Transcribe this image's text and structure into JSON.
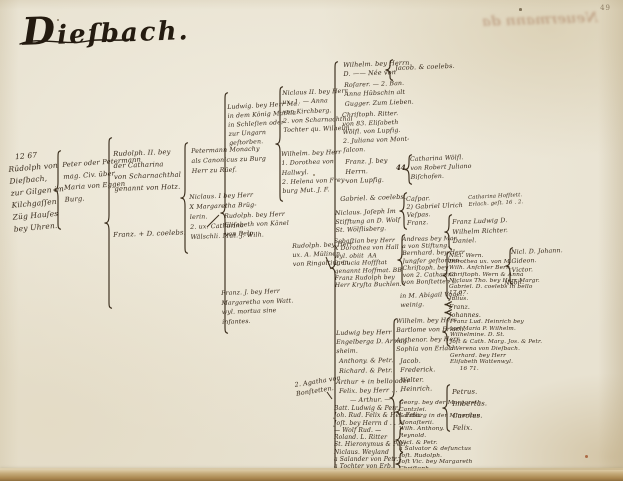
{
  "page": {
    "title": "Dieſbach.",
    "page_number": "49",
    "showthrough_text": "Neuermann da",
    "colors": {
      "ink": "#35281a",
      "ink_dark": "#241b10",
      "paper": "#e8e2d1",
      "bottom_edge": "#aa874f"
    }
  },
  "tree": {
    "entries": [
      {
        "id": "gen1-rudolph",
        "x": 7,
        "y": 152,
        "size": 7.5,
        "lh": 12,
        "rot": -5,
        "lines": [
          "   12 67",
          "Rüdolph von",
          "Dieſbach,",
          "zur Gilgen im",
          "Kilchgaſſen",
          "Züg Hauſes",
          "bey Uhren."
        ]
      },
      {
        "id": "gen2-peter",
        "x": 62,
        "y": 160,
        "size": 6.8,
        "lh": 11.5,
        "rot": -4,
        "lines": [
          "Peter oder Petermann",
          "mag. Civ. über",
          "Maria von Eggen",
          "Burg."
        ]
      },
      {
        "id": "gen3-rudolph-ii",
        "x": 113,
        "y": 149,
        "size": 6.8,
        "lh": 11.5,
        "rot": -2,
        "lines": [
          "Rudolph. II. bey",
          "der Catharina",
          "von Scharnachthal",
          "genannt von Hotz."
        ]
      },
      {
        "id": "gen3-franz-coelebs",
        "x": 113,
        "y": 231,
        "size": 6.8,
        "lh": 9,
        "rot": -2,
        "lines": [
          "Franz. + D. coelebs."
        ]
      },
      {
        "id": "gen4-petermann-monachy",
        "x": 191,
        "y": 147,
        "size": 6.3,
        "lh": 10,
        "rot": -2,
        "lines": [
          "Petermann Monachy",
          "als Canonicus zu Burg",
          "Herr zu Rüef."
        ]
      },
      {
        "id": "gen4-niclaus-i",
        "x": 189,
        "y": 193,
        "size": 6.3,
        "lh": 10,
        "rot": -2,
        "lines": [
          "Niclaus. I bey Herr",
          "X Margaretha Brüg-",
          "lerin.",
          "2. ux. Catharina",
          "Wälschli. Mut. J. Wilh."
        ]
      },
      {
        "id": "gen5-ludwig",
        "x": 227,
        "y": 103,
        "size": 6.2,
        "lh": 9,
        "rot": -3,
        "lines": [
          "Ludwig. bey Herr Ma.",
          "in dem König Mathia",
          "in Schleſien oder",
          "zur Ungarn",
          "geſtorben."
        ]
      },
      {
        "id": "gen5-rudolph",
        "x": 224,
        "y": 212,
        "size": 6.2,
        "lh": 9,
        "rot": -2,
        "lines": [
          "Rudolph. bey Herr",
          "Eliſabeth von Känel",
          "von Belp."
        ]
      },
      {
        "id": "gen5-franz",
        "x": 221,
        "y": 289,
        "size": 6.2,
        "lh": 9.5,
        "rot": -2,
        "lines": [
          "Franz. J. bey Herr",
          "Margaretha von Watt.",
          "wyl. mortua sine",
          "infantes."
        ]
      },
      {
        "id": "gen6-niclaus-ii",
        "x": 282,
        "y": 89,
        "size": 6.2,
        "lh": 9.3,
        "rot": -2,
        "lines": [
          "Niclaus II. bey Herr",
          "ux. 1. — Anna",
          "von Kirchberg.",
          "2. von Scharnachthal",
          "Tochter qu. Wilhelm."
        ]
      },
      {
        "id": "gen6-wilhelm",
        "x": 281,
        "y": 150,
        "size": 6.2,
        "lh": 9.3,
        "rot": -2,
        "lines": [
          "Wilhelm. bey Herr",
          "1. Dorothea von",
          "Hallwyl.",
          "2. Helena von Frey-",
          "burg Mut. J. F."
        ]
      },
      {
        "id": "gen6-rudolph",
        "x": 292,
        "y": 242,
        "size": 6.2,
        "lh": 9,
        "rot": -2,
        "lines": [
          "Rudolph. bey Herr",
          "ux. A. Mülinen",
          "von Ringoltingen."
        ]
      },
      {
        "id": "note-agatha",
        "x": 294,
        "y": 381,
        "size": 6.4,
        "lh": 9,
        "rot": -9,
        "lines": [
          "2. Agatha von",
          "Bonſtetten."
        ]
      },
      {
        "id": "gen7-wilhelm",
        "x": 343,
        "y": 61,
        "size": 6.4,
        "lh": 9,
        "rot": -2,
        "lines": [
          "Wilhelm. bey Herrn",
          "D. —— Née von"
        ]
      },
      {
        "id": "gen7-rosarer",
        "x": 344,
        "y": 81,
        "size": 6.2,
        "lh": 9.3,
        "rot": -2,
        "lines": [
          "Roſarer. — 2. Ban.",
          "Anna Hübschin alt",
          "Gugger. Zum Lieben."
        ]
      },
      {
        "id": "gen7-christoph",
        "x": 342,
        "y": 112,
        "size": 6.2,
        "lh": 8.7,
        "rot": -2,
        "lines": [
          "Chriſtoph. Ritter.",
          "von 83. Eliſabeth",
          "Wölfl. von Lupfig.",
          "2. Juliana von Mont-",
          "falcon."
        ]
      },
      {
        "id": "gen7-franz",
        "x": 345,
        "y": 158,
        "size": 6.4,
        "lh": 9.5,
        "rot": -2,
        "lines": [
          "Franz. J. bey",
          "Herrn.",
          "von Lupfig."
        ]
      },
      {
        "id": "gen7-gabriel",
        "x": 340,
        "y": 195,
        "size": 6.5,
        "lh": 9,
        "rot": -2,
        "lines": [
          "Gabriel. & coelebs."
        ]
      },
      {
        "id": "gen7-niclaus-joseph",
        "x": 335,
        "y": 210,
        "size": 6.2,
        "lh": 8.5,
        "rot": -2,
        "lines": [
          "Niclaus. Joſeph Im",
          "Stifftung an D. Wolf",
          "St. Wölflisberg."
        ]
      },
      {
        "id": "gen7-sebastian",
        "x": 334,
        "y": 238,
        "size": 6,
        "lh": 7.4,
        "rot": -1,
        "lines": [
          "Sebaſtian bey Herr",
          "X Dorothea von Hall",
          "wyl. obiit  AA",
          "2. Lucia Hoffſtat",
          "genannt Hoffmat. BB",
          "Franz Rudolph bey",
          "Herr Kryſta Buchlen."
        ]
      },
      {
        "id": "gen7-abigail",
        "x": 400,
        "y": 293,
        "size": 6.2,
        "lh": 8.5,
        "rot": -2,
        "lines": [
          "in M. Abigail Vogel.",
          "weinig."
        ]
      },
      {
        "id": "gen7-ludwig",
        "x": 336,
        "y": 330,
        "size": 6.2,
        "lh": 8.8,
        "rot": -1,
        "lines": [
          "Ludwig bey Herr",
          "Engelberga D. Armag.",
          "sheim."
        ]
      },
      {
        "id": "gen7-anthony",
        "x": 339,
        "y": 358,
        "size": 6.3,
        "lh": 8,
        "rot": -1,
        "lines": [
          "Anthony. & Petr."
        ]
      },
      {
        "id": "gen7-richard",
        "x": 339,
        "y": 368,
        "size": 6.3,
        "lh": 8,
        "rot": -1,
        "lines": [
          "Richard. & Petr."
        ]
      },
      {
        "id": "gen7-arthur-bello",
        "x": 336,
        "y": 379,
        "size": 6.3,
        "lh": 8,
        "rot": -1,
        "lines": [
          "Arthur + in bello oder"
        ]
      },
      {
        "id": "gen7-felix",
        "x": 339,
        "y": 388,
        "size": 6.3,
        "lh": 8,
        "rot": -1,
        "lines": [
          "Felix. bey Herr . . ."
        ]
      },
      {
        "id": "gen7-arthur",
        "x": 350,
        "y": 397,
        "size": 6.3,
        "lh": 8,
        "rot": -1,
        "lines": [
          "— Arthur. —"
        ]
      },
      {
        "id": "gen7-list",
        "x": 334,
        "y": 405,
        "size": 6,
        "lh": 7.3,
        "rot": 0,
        "lines": [
          "Batt. Ludwig & Petr.",
          "Joh. Rud. Felix & Hel. Felix",
          "Joſt. bey Herrn d . . . .",
          "— Wolf Rud. —",
          "Roland. L. Ritter",
          "St. Hieronymus & Petr.",
          "Niclaus. Weyland",
          "a Salander von Petr.",
          "a Tochter von Erb."
        ]
      },
      {
        "id": "gen8-jacob-coelebs",
        "x": 395,
        "y": 64,
        "size": 6.5,
        "lh": 9,
        "rot": -2,
        "lines": [
          "Jacob. & coelebs."
        ]
      },
      {
        "id": "gen8-catharina",
        "x": 410,
        "y": 156,
        "size": 6.2,
        "lh": 8.8,
        "rot": -2,
        "lines": [
          "Catharina Wölfl.",
          "von Robert Juliano",
          "Biſchofen."
        ]
      },
      {
        "id": "gen8-caspar",
        "x": 406,
        "y": 196,
        "size": 6.3,
        "lh": 8,
        "rot": -2,
        "lines": [
          "Caſpar.",
          "2) Gabriel Ulrich",
          "Veſpas.",
          "Franz."
        ]
      },
      {
        "id": "gen8-andreas",
        "x": 402,
        "y": 236,
        "size": 6,
        "lh": 7.2,
        "rot": -1,
        "lines": [
          "Andreas bey Mar.",
          "a von Stiftung.",
          "Bernhard. bey Herr",
          "Jungfer geſtorben.",
          "Chriſtoph. bey",
          "von 2. Catharina",
          "von Bonſtetten L."
        ]
      },
      {
        "id": "gen8-wilhelm-erlach",
        "x": 396,
        "y": 318,
        "size": 6.2,
        "lh": 8.5,
        "rot": -1,
        "lines": [
          "Wilhelm. bey Herr",
          "Bartlome von Erlach."
        ]
      },
      {
        "id": "gen8-anthenor-erlach",
        "x": 396,
        "y": 337,
        "size": 6.2,
        "lh": 8.5,
        "rot": -1,
        "lines": [
          "Anthenor. bey Herr",
          "Sophia von Erlach."
        ]
      },
      {
        "id": "gen8-sons",
        "x": 400,
        "y": 357,
        "size": 6.4,
        "lh": 9.3,
        "rot": -1,
        "lines": [
          "Jacob.",
          "Frederick.",
          "Walter.",
          "Heinrich."
        ]
      },
      {
        "id": "gen8-georg-list",
        "x": 399,
        "y": 400,
        "size": 5.9,
        "lh": 6.6,
        "rot": 0,
        "lines": [
          "Georg. bey der Margareth",
          "Cantzlei.",
          "Salzburg in der Minoriten",
          "Monaſterii.",
          "Wilh. Anthony.",
          "Reynold.",
          "Nicl. & Petr.",
          "a Salvator & defunctus",
          "Joſt. Rudolph.",
          "Joſt Vic. bey Margareth",
          "Chriſtoph.",
          "Deutſchland."
        ]
      },
      {
        "id": "gen9-note-catharina",
        "x": 468,
        "y": 195,
        "size": 5.3,
        "lh": 7,
        "rot": -3,
        "lines": [
          "Catharina Hofſtett.",
          "Erlach. geſt. 16 . 2."
        ]
      },
      {
        "id": "gen9-franz-ludwig",
        "x": 452,
        "y": 218,
        "size": 6.3,
        "lh": 9.5,
        "rot": -2,
        "lines": [
          "Franz Ludwig D.",
          "Wilhelm Richter.",
          "Daniel."
        ]
      },
      {
        "id": "gen9-niclaus-group",
        "x": 449,
        "y": 253,
        "size": 5.8,
        "lh": 6.2,
        "rot": 0,
        "lines": [
          "Nicl. Wern.",
          "Dorothea ux. von M.",
          "Wilh. Anſchler Bern.",
          "Chriſtoph. Wern & Anna",
          "Niclaus Tho. bey Herr Margr.",
          "Gabriel. D. coelebs in bello",
          "17 67.",
          "Julius."
        ]
      },
      {
        "id": "gen9-franz-johannes",
        "x": 449,
        "y": 304,
        "size": 6.2,
        "lh": 8,
        "rot": 0,
        "lines": [
          "Franz.",
          "Johannes."
        ]
      },
      {
        "id": "gen9-heinrich-group",
        "x": 450,
        "y": 319,
        "size": 5.7,
        "lh": 6.7,
        "rot": 0,
        "lines": [
          "Franz Lud. Heinrich bey",
          "von Maria P. Wilhelm.",
          "Wilhelmine. D. St.",
          "Joſt & Cath. Marg. Jos. & Petr.",
          "a Verena von Dieſbach.",
          "Gerhard. bey Herr",
          "Eliſabeth Wattenwyl.",
          "     16 71."
        ]
      },
      {
        "id": "gen9-petrus-group",
        "x": 452,
        "y": 386,
        "size": 6.8,
        "lh": 12,
        "rot": -1,
        "lines": [
          "Petrus.",
          "Imbertus.",
          "Carolus.",
          "Felix."
        ]
      },
      {
        "id": "gen10-nicl-johann",
        "x": 511,
        "y": 249,
        "size": 6.2,
        "lh": 8.8,
        "rot": -2,
        "lines": [
          "Nicl. D. Johann.",
          "Gideon.",
          "Victor."
        ]
      },
      {
        "id": "gen10-nobil",
        "x": 504,
        "y": 280,
        "size": 6.2,
        "lh": 8,
        "rot": -4,
        "lines": [
          "Nobil."
        ]
      }
    ],
    "braces": [
      {
        "id": "brace-gen1",
        "x": 52,
        "y": 150,
        "h": 80
      },
      {
        "id": "brace-gen2",
        "x": 103,
        "y": 137,
        "h": 172
      },
      {
        "id": "brace-gen3",
        "x": 179,
        "y": 142,
        "h": 112
      },
      {
        "id": "brace-gen4",
        "x": 219,
        "y": 92,
        "h": 242
      },
      {
        "id": "brace-gen5",
        "x": 274,
        "y": 86,
        "h": 116
      },
      {
        "id": "brace-gen6-main",
        "x": 329,
        "y": 61,
        "h": 414
      },
      {
        "id": "brace-jacob",
        "x": 384,
        "y": 59,
        "h": 22
      },
      {
        "id": "brace-catharina",
        "x": 403,
        "y": 154,
        "h": 31
      },
      {
        "id": "brace-caspar",
        "x": 398,
        "y": 192,
        "h": 38
      },
      {
        "id": "brace-andreas",
        "x": 396,
        "y": 234,
        "h": 52
      },
      {
        "id": "brace-erlach-spine",
        "x": 388,
        "y": 318,
        "h": 160
      },
      {
        "id": "brace-georg-1",
        "x": 394,
        "y": 399,
        "h": 26
      },
      {
        "id": "brace-georg-2",
        "x": 394,
        "y": 427,
        "h": 26
      },
      {
        "id": "brace-georg-3",
        "x": 394,
        "y": 452,
        "h": 24
      },
      {
        "id": "brace-franz-ludwig",
        "x": 443,
        "y": 214,
        "h": 36
      },
      {
        "id": "brace-niclaus-group",
        "x": 441,
        "y": 251,
        "h": 49
      },
      {
        "id": "brace-franz-sm",
        "x": 443,
        "y": 301,
        "h": 7
      },
      {
        "id": "brace-johannes-sm",
        "x": 443,
        "y": 309,
        "h": 7
      },
      {
        "id": "brace-heinrich",
        "x": 441,
        "y": 317,
        "h": 30
      },
      {
        "id": "brace-petrus",
        "x": 441,
        "y": 384,
        "h": 48
      },
      {
        "id": "brace-nicl-johann",
        "x": 504,
        "y": 247,
        "h": 38
      }
    ],
    "marks": [
      {
        "id": "mark-44",
        "x": 396,
        "y": 163,
        "text": "44",
        "size": 7
      }
    ],
    "connectors": [
      {
        "x1": 206,
        "y1": 226,
        "x2": 218,
        "y2": 214
      },
      {
        "x1": 325,
        "y1": 256,
        "x2": 330,
        "y2": 268
      },
      {
        "x1": 326,
        "y1": 391,
        "x2": 331,
        "y2": 398
      }
    ],
    "specks": [
      {
        "x": 57,
        "y": 19,
        "r": 1.2,
        "color": "#6b5c44"
      },
      {
        "x": 519,
        "y": 8,
        "r": 1.3,
        "color": "#6b5c44"
      },
      {
        "x": 313,
        "y": 174,
        "r": 1.0,
        "color": "#7a6a50"
      },
      {
        "x": 585,
        "y": 455,
        "r": 1.6,
        "color": "#a0522d"
      }
    ]
  }
}
